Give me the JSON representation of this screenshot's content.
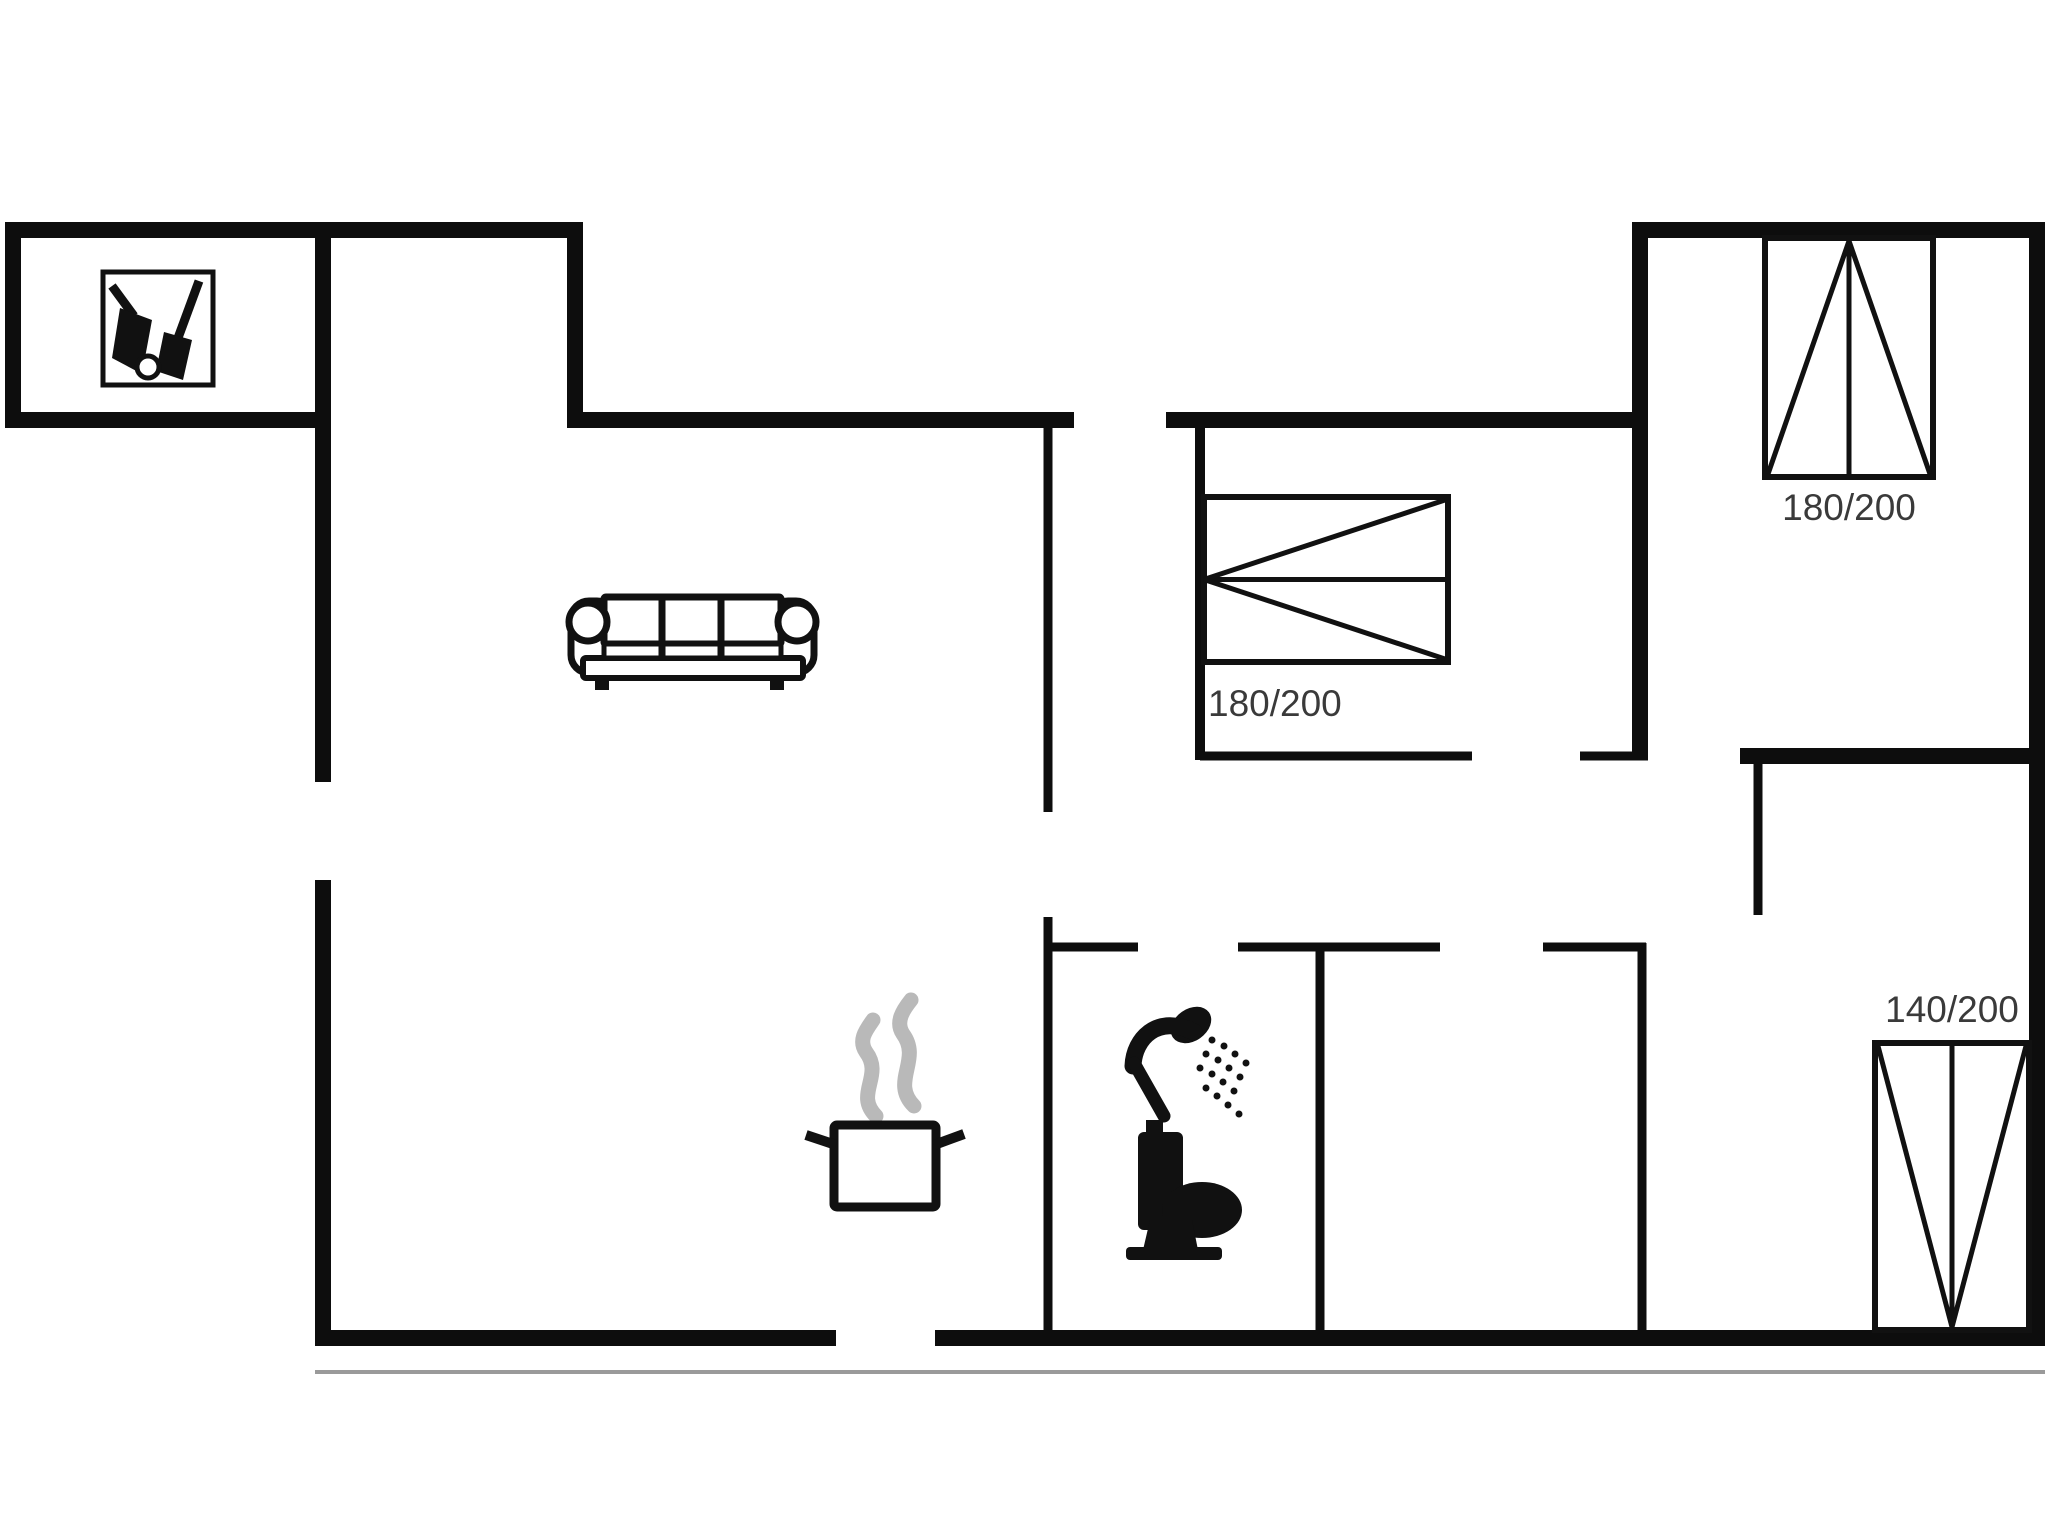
{
  "canvas": {
    "width": 2048,
    "height": 1536,
    "background": "#ffffff",
    "wall_color": "#0d0d0d",
    "icon_color": "#111111",
    "label_color": "#3a3a3a",
    "steam_color": "#b9b9b9",
    "offset_line_color": "#9a9a9a",
    "label_font_size": 37
  },
  "walls": {
    "horizontal": [
      {
        "x1": 5,
        "x2": 583,
        "y": 230,
        "t": 16
      },
      {
        "x1": 1632,
        "x2": 2045,
        "y": 230,
        "t": 16
      },
      {
        "x1": 5,
        "x2": 331,
        "y": 420,
        "t": 16
      },
      {
        "x1": 567,
        "x2": 1074,
        "y": 420,
        "t": 16
      },
      {
        "x1": 1166,
        "x2": 1648,
        "y": 420,
        "t": 16
      },
      {
        "x1": 1200,
        "x2": 1472,
        "y": 756,
        "t": 9
      },
      {
        "x1": 1580,
        "x2": 1648,
        "y": 756,
        "t": 9
      },
      {
        "x1": 1740,
        "x2": 2045,
        "y": 756,
        "t": 16
      },
      {
        "x1": 1048,
        "x2": 1138,
        "y": 947,
        "t": 9
      },
      {
        "x1": 1238,
        "x2": 1440,
        "y": 947,
        "t": 9
      },
      {
        "x1": 1543,
        "x2": 1646,
        "y": 947,
        "t": 9
      },
      {
        "x1": 315,
        "x2": 836,
        "y": 1338,
        "t": 16
      },
      {
        "x1": 935,
        "x2": 2045,
        "y": 1338,
        "t": 16
      }
    ],
    "vertical": [
      {
        "y1": 222,
        "y2": 428,
        "x": 13,
        "t": 16
      },
      {
        "y1": 222,
        "y2": 782,
        "x": 323,
        "t": 16
      },
      {
        "y1": 880,
        "y2": 1346,
        "x": 323,
        "t": 16
      },
      {
        "y1": 222,
        "y2": 428,
        "x": 575,
        "t": 16
      },
      {
        "y1": 420,
        "y2": 812,
        "x": 1048,
        "t": 9
      },
      {
        "y1": 917,
        "y2": 1343,
        "x": 1048,
        "t": 9
      },
      {
        "y1": 420,
        "y2": 760,
        "x": 1200,
        "t": 10
      },
      {
        "y1": 943,
        "y2": 1343,
        "x": 1320,
        "t": 9
      },
      {
        "y1": 222,
        "y2": 760,
        "x": 1640,
        "t": 16
      },
      {
        "y1": 943,
        "y2": 1343,
        "x": 1642,
        "t": 9
      },
      {
        "y1": 752,
        "y2": 915,
        "x": 1758,
        "t": 9
      },
      {
        "y1": 222,
        "y2": 1346,
        "x": 2037,
        "t": 16
      }
    ],
    "offset_line": {
      "x1": 315,
      "x2": 2045,
      "y": 1372,
      "t": 4
    }
  },
  "beds": [
    {
      "id": "bed-bedroom-middle",
      "x": 1204,
      "y": 497,
      "w": 244,
      "h": 165,
      "divider": "h",
      "apex": "left",
      "label": "180/200",
      "label_x": 1208,
      "label_y": 716,
      "label_anchor": "start"
    },
    {
      "id": "bed-bedroom-top-right",
      "x": 1765,
      "y": 238,
      "w": 168,
      "h": 239,
      "divider": "v",
      "apex": "top",
      "label": "180/200",
      "label_x": 1849,
      "label_y": 520,
      "label_anchor": "middle"
    },
    {
      "id": "bed-bedroom-bottom-right",
      "x": 1875,
      "y": 1043,
      "w": 154,
      "h": 287,
      "divider": "v",
      "apex": "bottom",
      "label": "140/200",
      "label_x": 1952,
      "label_y": 1022,
      "label_anchor": "middle"
    }
  ],
  "icons": [
    {
      "name": "sofa-icon",
      "shapes": [
        {
          "k": "rect",
          "x": 571,
          "y": 601,
          "w": 44,
          "h": 72,
          "rx": 18,
          "f": "#fff",
          "s": "#111",
          "sw": 7
        },
        {
          "k": "rect",
          "x": 770,
          "y": 601,
          "w": 44,
          "h": 72,
          "rx": 18,
          "f": "#fff",
          "s": "#111",
          "sw": 7
        },
        {
          "k": "rect",
          "x": 583,
          "y": 658,
          "w": 220,
          "h": 20,
          "rx": 3,
          "f": "#fff",
          "s": "#111",
          "sw": 6
        },
        {
          "k": "rect",
          "x": 604,
          "y": 597,
          "w": 177,
          "h": 47,
          "rx": 2,
          "f": "#fff",
          "s": "#111",
          "sw": 7
        },
        {
          "k": "rect",
          "x": 604,
          "y": 644,
          "w": 177,
          "h": 14,
          "rx": 0,
          "f": "#fff",
          "s": "#111",
          "sw": 5
        },
        {
          "k": "line",
          "x1": 662,
          "y1": 600,
          "x2": 662,
          "y2": 657,
          "sw": 7
        },
        {
          "k": "line",
          "x1": 721,
          "y1": 600,
          "x2": 721,
          "y2": 657,
          "sw": 7
        },
        {
          "k": "circle",
          "cx": 588,
          "cy": 622,
          "r": 19,
          "f": "#fff",
          "s": "#111",
          "sw": 7
        },
        {
          "k": "circle",
          "cx": 797,
          "cy": 622,
          "r": 19,
          "f": "#fff",
          "s": "#111",
          "sw": 7
        },
        {
          "k": "rect",
          "x": 595,
          "y": 677,
          "w": 14,
          "h": 13,
          "f": "#111"
        },
        {
          "k": "rect",
          "x": 770,
          "y": 677,
          "w": 14,
          "h": 13,
          "f": "#111"
        }
      ]
    },
    {
      "name": "cleaning-tools-icon",
      "shapes": [
        {
          "k": "rect",
          "x": 103,
          "y": 272,
          "w": 110,
          "h": 113,
          "f": "#fff",
          "s": "#111",
          "sw": 5
        },
        {
          "k": "line",
          "x1": 199,
          "y1": 281,
          "x2": 178,
          "y2": 338,
          "sw": 9
        },
        {
          "k": "polygon",
          "pts": "164,332 192,340 183,380 156,371",
          "f": "#111"
        },
        {
          "k": "line",
          "x1": 112,
          "y1": 286,
          "x2": 134,
          "y2": 316,
          "sw": 9
        },
        {
          "k": "polygon",
          "pts": "120,308 152,320 142,374 112,358",
          "f": "#111"
        },
        {
          "k": "circle",
          "cx": 148,
          "cy": 367,
          "r": 11,
          "f": "#fff",
          "s": "#111",
          "sw": 5
        }
      ]
    },
    {
      "name": "cooking-pot-icon",
      "shapes": [
        {
          "k": "path",
          "d": "M 876 1116 C 854 1094 884 1076 866 1052 C 858 1040 866 1030 873 1020",
          "s": "#b9b9b9",
          "sw": 15,
          "cap": "round"
        },
        {
          "k": "path",
          "d": "M 914 1106 C 890 1082 922 1060 903 1034 C 895 1022 903 1010 911 1000",
          "s": "#b9b9b9",
          "sw": 15,
          "cap": "round"
        },
        {
          "k": "rect",
          "x": 834,
          "y": 1125,
          "w": 102,
          "h": 82,
          "rx": 3,
          "f": "#fff",
          "s": "#111",
          "sw": 9
        },
        {
          "k": "line",
          "x1": 806,
          "y1": 1135,
          "x2": 836,
          "y2": 1145,
          "sw": 10
        },
        {
          "k": "line",
          "x1": 934,
          "y1": 1145,
          "x2": 964,
          "y2": 1134,
          "sw": 10
        }
      ]
    },
    {
      "name": "shower-icon",
      "shapes": [
        {
          "k": "ellipse",
          "cx": 1191,
          "cy": 1025,
          "rx": 22,
          "ry": 16,
          "rot": -35,
          "f": "#111"
        },
        {
          "k": "path",
          "d": "M 1194 1032 C 1158 1014 1134 1038 1133 1066",
          "s": "#111",
          "sw": 17,
          "cap": "round"
        },
        {
          "k": "line",
          "x1": 1134,
          "y1": 1063,
          "x2": 1164,
          "y2": 1116,
          "sw": 13,
          "cap": "round"
        },
        {
          "k": "circle",
          "cx": 1212,
          "cy": 1040,
          "r": 3.5,
          "f": "#111"
        },
        {
          "k": "circle",
          "cx": 1206,
          "cy": 1054,
          "r": 3.5,
          "f": "#111"
        },
        {
          "k": "circle",
          "cx": 1200,
          "cy": 1068,
          "r": 3.5,
          "f": "#111"
        },
        {
          "k": "circle",
          "cx": 1224,
          "cy": 1046,
          "r": 3.5,
          "f": "#111"
        },
        {
          "k": "circle",
          "cx": 1218,
          "cy": 1060,
          "r": 3.5,
          "f": "#111"
        },
        {
          "k": "circle",
          "cx": 1212,
          "cy": 1074,
          "r": 3.5,
          "f": "#111"
        },
        {
          "k": "circle",
          "cx": 1206,
          "cy": 1088,
          "r": 3.5,
          "f": "#111"
        },
        {
          "k": "circle",
          "cx": 1235,
          "cy": 1054,
          "r": 3.5,
          "f": "#111"
        },
        {
          "k": "circle",
          "cx": 1229,
          "cy": 1068,
          "r": 3.5,
          "f": "#111"
        },
        {
          "k": "circle",
          "cx": 1223,
          "cy": 1082,
          "r": 3.5,
          "f": "#111"
        },
        {
          "k": "circle",
          "cx": 1217,
          "cy": 1096,
          "r": 3.5,
          "f": "#111"
        },
        {
          "k": "circle",
          "cx": 1246,
          "cy": 1063,
          "r": 3.5,
          "f": "#111"
        },
        {
          "k": "circle",
          "cx": 1240,
          "cy": 1077,
          "r": 3.5,
          "f": "#111"
        },
        {
          "k": "circle",
          "cx": 1234,
          "cy": 1091,
          "r": 3.5,
          "f": "#111"
        },
        {
          "k": "circle",
          "cx": 1228,
          "cy": 1105,
          "r": 3.5,
          "f": "#111"
        },
        {
          "k": "circle",
          "cx": 1239,
          "cy": 1114,
          "r": 3.5,
          "f": "#111"
        }
      ]
    },
    {
      "name": "toilet-icon",
      "shapes": [
        {
          "k": "rect",
          "x": 1146,
          "y": 1120,
          "w": 17,
          "h": 16,
          "f": "#111"
        },
        {
          "k": "rect",
          "x": 1138,
          "y": 1132,
          "w": 45,
          "h": 98,
          "rx": 6,
          "f": "#111"
        },
        {
          "k": "ellipse",
          "cx": 1202,
          "cy": 1210,
          "rx": 40,
          "ry": 28,
          "rot": 0,
          "f": "#111"
        },
        {
          "k": "polygon",
          "pts": "1150,1220 1192,1220 1198,1250 1143,1250",
          "f": "#111"
        },
        {
          "k": "rect",
          "x": 1126,
          "y": 1247,
          "w": 96,
          "h": 13,
          "rx": 4,
          "f": "#111"
        }
      ]
    }
  ]
}
